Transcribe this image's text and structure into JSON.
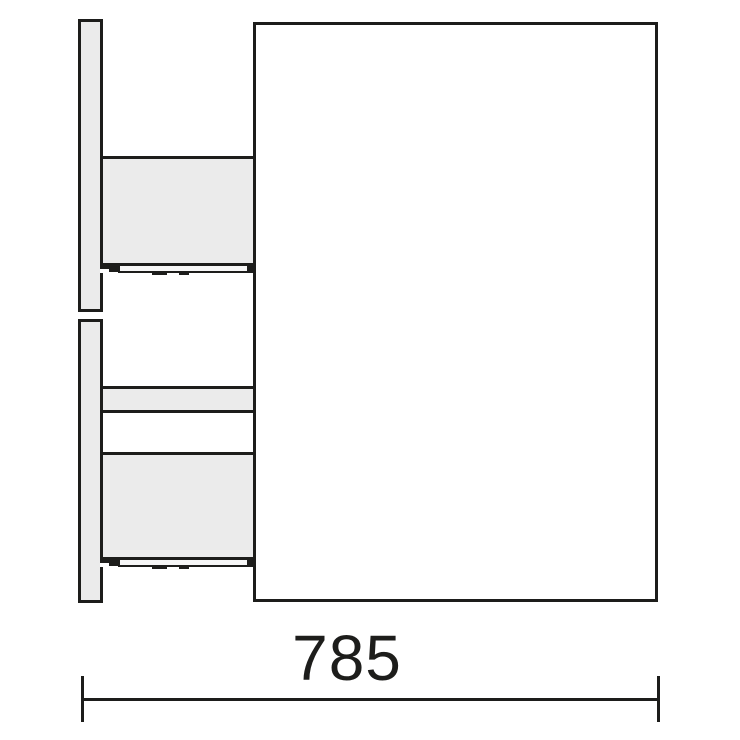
{
  "dimension": {
    "width_label": "785"
  },
  "colors": {
    "line": "#1d1d1b",
    "panel_fill": "#ebebeb",
    "rail_fill": "#f6f6f6",
    "background": "#ffffff"
  }
}
